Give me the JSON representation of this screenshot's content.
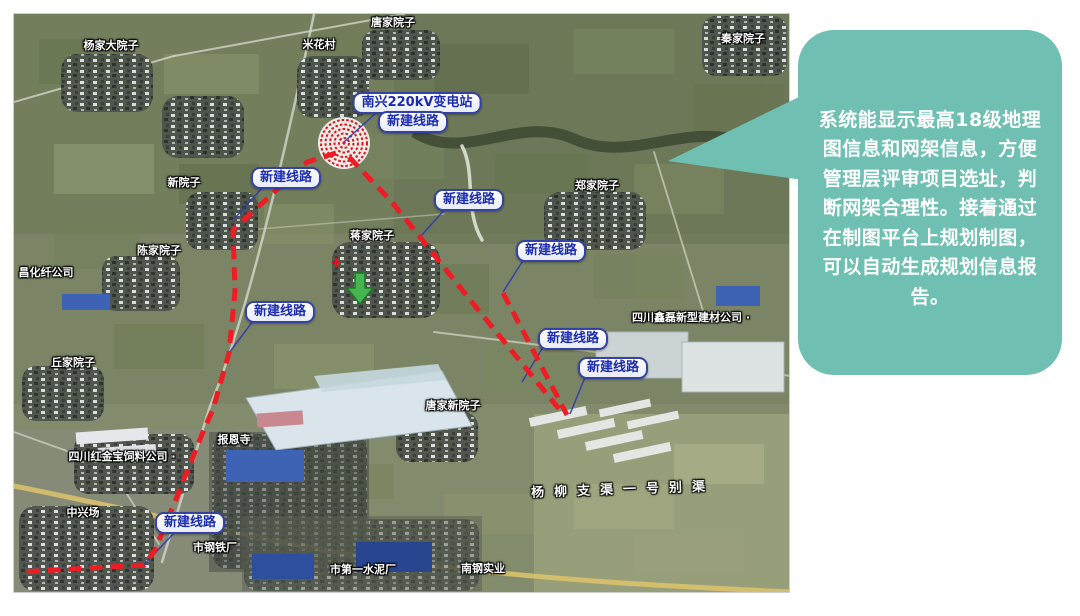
{
  "callout": {
    "text": "系统能显示最高18级地理图信息和网架信息，方便管理层评审项目选址，判断网架合理性。接着通过在制图平台上规划制图，可以自动生成规划信息报告。",
    "bg_color": "#6FC0B2",
    "text_color": "#FFFFFF"
  },
  "map": {
    "substation_label": {
      "text": "南兴220kV变电站"
    },
    "route_labels": [
      {
        "text": "新建线路"
      },
      {
        "text": "新建线路"
      },
      {
        "text": "新建线路"
      },
      {
        "text": "新建线路"
      },
      {
        "text": "新建线路"
      },
      {
        "text": "新建线路"
      },
      {
        "text": "新建线路"
      },
      {
        "text": "新建线路"
      }
    ],
    "places": [
      {
        "name": "杨家大院子"
      },
      {
        "name": "米花村"
      },
      {
        "name": "唐家院子"
      },
      {
        "name": "秦家院子"
      },
      {
        "name": "新院子"
      },
      {
        "name": "郑家院子"
      },
      {
        "name": "陈家院子"
      },
      {
        "name": "昌化纤公司"
      },
      {
        "name": "蒋家院子"
      },
      {
        "name": "丘家院子"
      },
      {
        "name": "四川鑫磊新型建材公司 ·"
      },
      {
        "name": "唐家新院子"
      },
      {
        "name": "报恩寺"
      },
      {
        "name": "四川红金宝饲料公司 ·"
      },
      {
        "name": "中兴场"
      },
      {
        "name": "市钢铁厂"
      },
      {
        "name": "市第一水泥厂"
      },
      {
        "name": "南钢实业"
      },
      {
        "name": "杨柳支渠一号别渠"
      }
    ],
    "markers": {
      "substation_marker": "red-dashed-concentric-circles",
      "location_arrow": "green-down-arrow",
      "cross_marker": "red-plus"
    },
    "colors": {
      "route_line": "#EE1C25",
      "label_text": "#1B2CAE",
      "label_border": "#3442A2",
      "place_text": "#FFFFFF"
    }
  }
}
